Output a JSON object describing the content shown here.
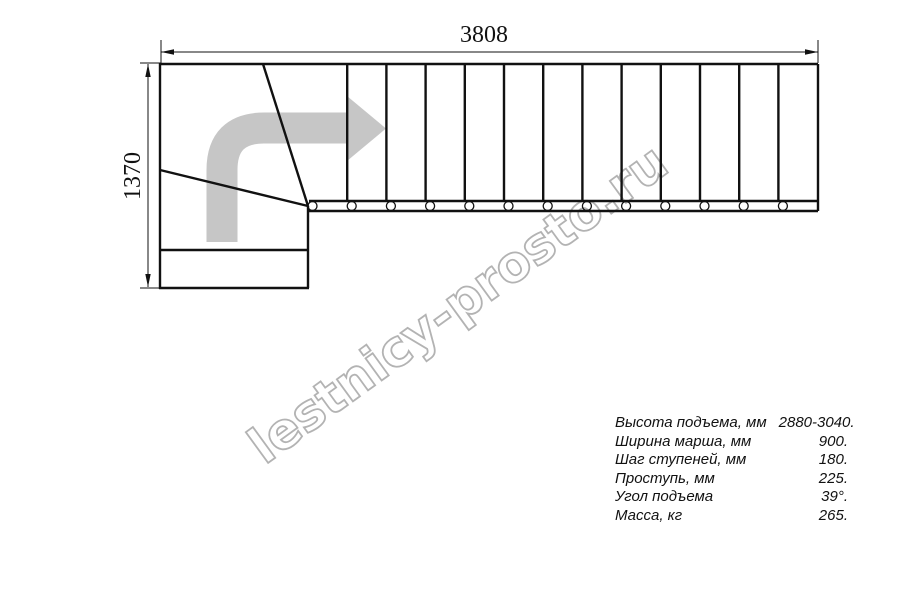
{
  "dimensions": {
    "width_mm": "3808",
    "height_mm": "1370"
  },
  "watermark": "lestnicy-prosto.ru",
  "specs": {
    "rows": [
      {
        "label": "Высота подъема, мм",
        "value": "2880-3040."
      },
      {
        "label": "Ширина марша, мм",
        "value": "900."
      },
      {
        "label": "Шаг ступеней, мм",
        "value": "180."
      },
      {
        "label": "Проступь, мм",
        "value": "225."
      },
      {
        "label": "Угол подъема",
        "value": "39°."
      },
      {
        "label": "Масса, кг",
        "value": "265."
      }
    ]
  },
  "plan": {
    "type": "L-shaped staircase top view with winder turn",
    "straight_step_lines": 12,
    "baluster_count": 13,
    "direction_arrow": "up-then-right turn"
  },
  "colors": {
    "line": "#111111",
    "arrow": "#c6c6c6",
    "watermark": "#b3b3b3"
  }
}
